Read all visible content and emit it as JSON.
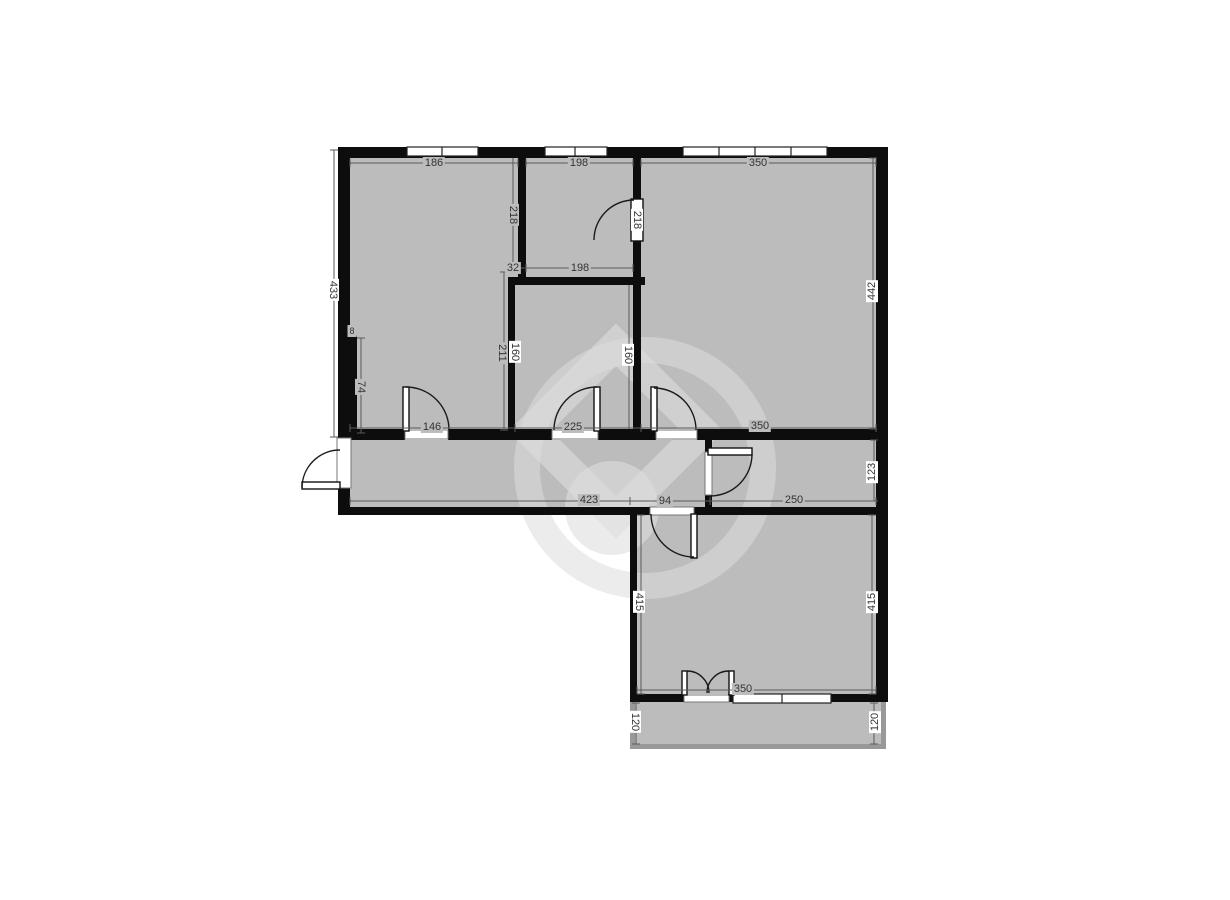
{
  "diagram_type": "apartment-floor-plan",
  "colors": {
    "background": "#ffffff",
    "room_fill": "#bcbcbc",
    "wall": "#0d0d0d",
    "balcony_wall": "#999999",
    "dimension_line": "#5a5a5a",
    "label_text": "#333333",
    "watermark": "#dddddd"
  },
  "floorplan": {
    "dimension_labels": [
      {
        "value": "186",
        "x": 434,
        "y": 163,
        "orient": "h",
        "bg": "gray"
      },
      {
        "value": "198",
        "x": 579,
        "y": 163,
        "orient": "h",
        "bg": "gray"
      },
      {
        "value": "350",
        "x": 758,
        "y": 163,
        "orient": "h",
        "bg": "gray"
      },
      {
        "value": "433",
        "x": 333,
        "y": 290,
        "orient": "vl",
        "bg": "white"
      },
      {
        "value": "442",
        "x": 872,
        "y": 291,
        "orient": "vr",
        "bg": "white"
      },
      {
        "value": "218",
        "x": 513,
        "y": 215,
        "orient": "vl",
        "bg": "gray"
      },
      {
        "value": "218",
        "x": 637,
        "y": 220,
        "orient": "vl",
        "bg": "white"
      },
      {
        "value": "32",
        "x": 513,
        "y": 268,
        "orient": "h",
        "bg": "gray"
      },
      {
        "value": "198",
        "x": 580,
        "y": 268,
        "orient": "h",
        "bg": "gray"
      },
      {
        "value": "211",
        "x": 502,
        "y": 353,
        "orient": "vl",
        "bg": "gray"
      },
      {
        "value": "160",
        "x": 515,
        "y": 352,
        "orient": "vl",
        "bg": "white"
      },
      {
        "value": "160",
        "x": 628,
        "y": 355,
        "orient": "vl",
        "bg": "white"
      },
      {
        "value": "8",
        "x": 352,
        "y": 331,
        "orient": "h",
        "bg": "gray",
        "small": true
      },
      {
        "value": "74",
        "x": 361,
        "y": 387,
        "orient": "vl",
        "bg": "gray"
      },
      {
        "value": "146",
        "x": 432,
        "y": 427,
        "orient": "h",
        "bg": "gray"
      },
      {
        "value": "225",
        "x": 573,
        "y": 427,
        "orient": "h",
        "bg": "gray"
      },
      {
        "value": "350",
        "x": 760,
        "y": 426,
        "orient": "h",
        "bg": "gray"
      },
      {
        "value": "423",
        "x": 589,
        "y": 500,
        "orient": "h",
        "bg": "gray"
      },
      {
        "value": "94",
        "x": 665,
        "y": 501,
        "orient": "h",
        "bg": "gray"
      },
      {
        "value": "250",
        "x": 794,
        "y": 500,
        "orient": "h",
        "bg": "gray"
      },
      {
        "value": "123",
        "x": 872,
        "y": 472,
        "orient": "vr",
        "bg": "white"
      },
      {
        "value": "415",
        "x": 639,
        "y": 602,
        "orient": "vl",
        "bg": "white"
      },
      {
        "value": "415",
        "x": 872,
        "y": 602,
        "orient": "vr",
        "bg": "white"
      },
      {
        "value": "350",
        "x": 743,
        "y": 689,
        "orient": "h",
        "bg": "gray"
      },
      {
        "value": "120",
        "x": 635,
        "y": 722,
        "orient": "vl",
        "bg": "white"
      },
      {
        "value": "120",
        "x": 875,
        "y": 722,
        "orient": "vr",
        "bg": "white"
      }
    ]
  }
}
